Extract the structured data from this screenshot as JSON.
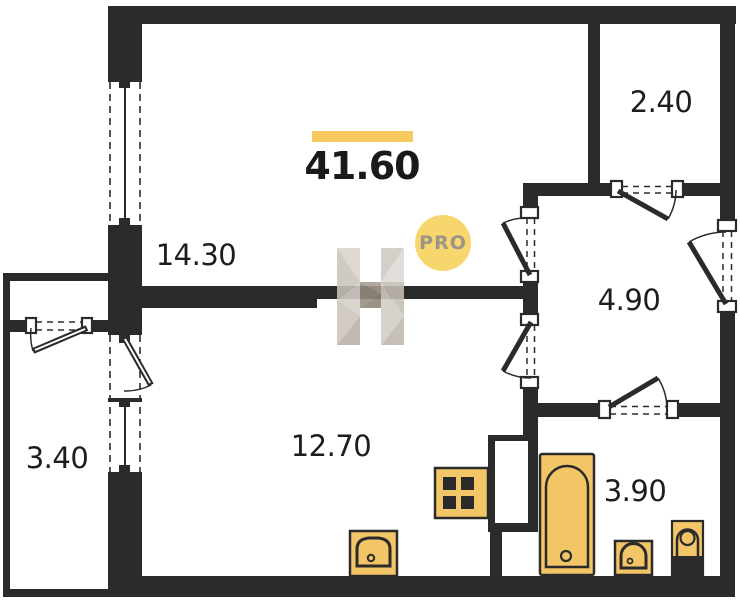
{
  "plan": {
    "total_area": "41.60",
    "areas": {
      "top_left_room": "14.30",
      "top_right_room": "2.40",
      "hall": "4.90",
      "bottom_room": "12.70",
      "balcony": "3.40",
      "bathroom": "3.90"
    },
    "watermark": {
      "letter": "H",
      "badge": "PRO"
    },
    "fixtures": [
      "stove-icon",
      "kitchen-sink-icon",
      "bathtub-icon",
      "washbasin-icon",
      "toilet-icon"
    ],
    "colors": {
      "wall": "#2b2b2b",
      "fixture": "#F2C567",
      "accent": "#F9C85E",
      "badge-fill": "#F7D66E",
      "badge-text": "#9C9488",
      "label": "#1d1d1d"
    }
  }
}
